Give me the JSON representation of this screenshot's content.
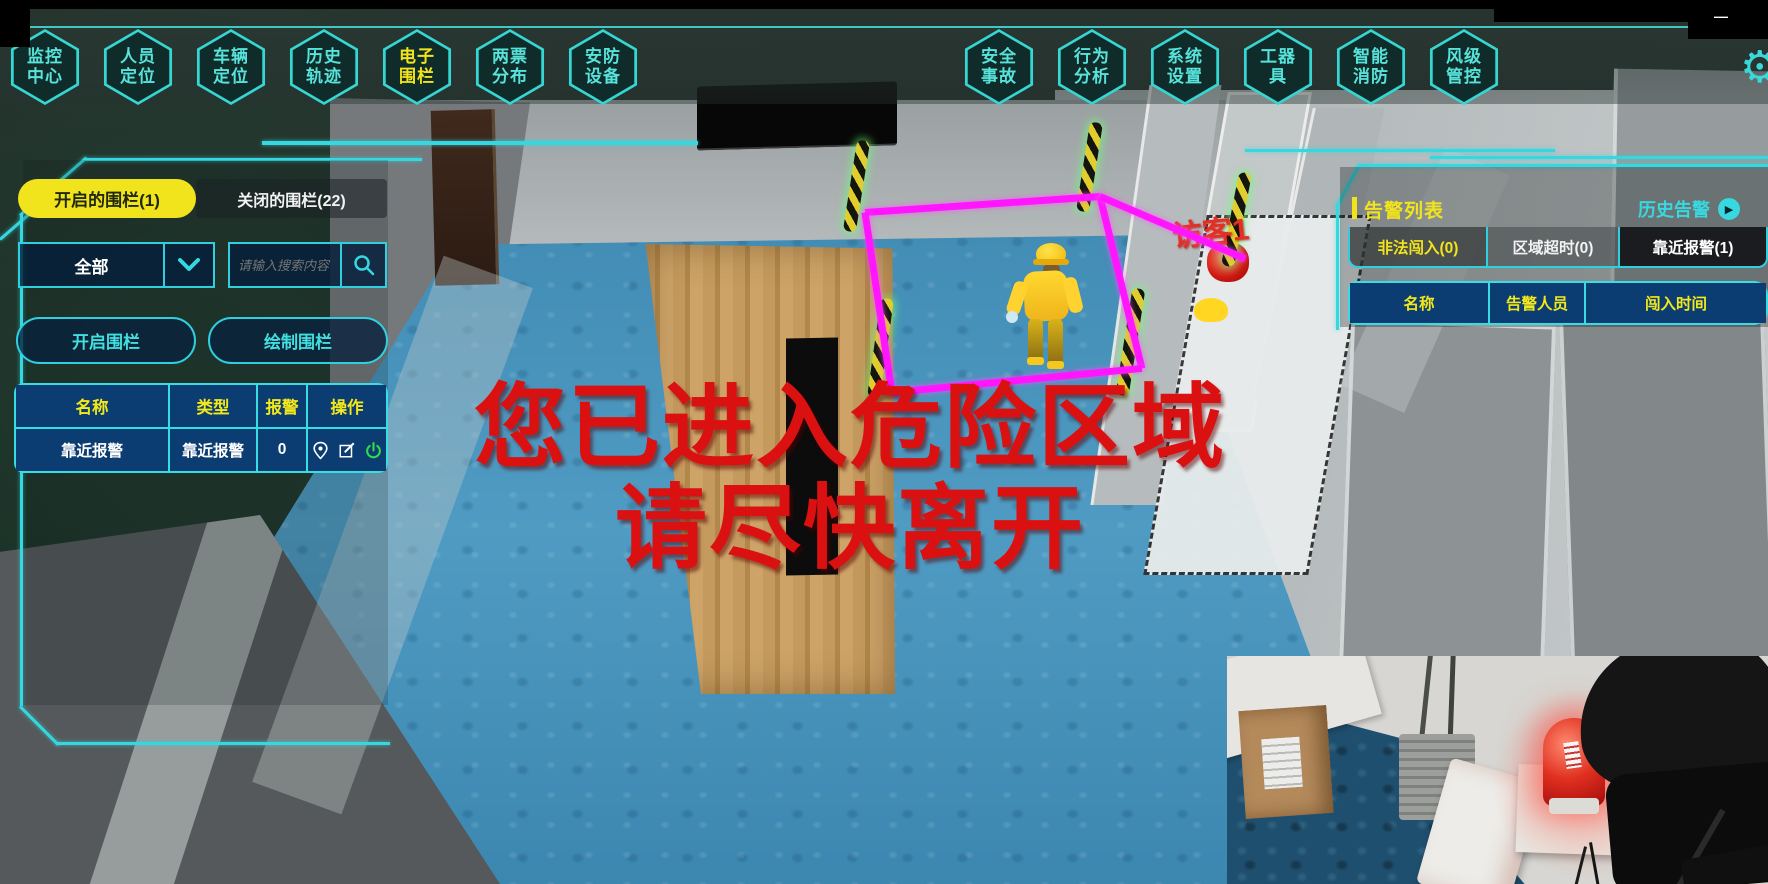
{
  "window": {
    "minimize_glyph": "—"
  },
  "nav": {
    "left": [
      {
        "line1": "监控",
        "line2": "中心"
      },
      {
        "line1": "人员",
        "line2": "定位"
      },
      {
        "line1": "车辆",
        "line2": "定位"
      },
      {
        "line1": "历史",
        "line2": "轨迹"
      },
      {
        "line1": "电子",
        "line2": "围栏"
      },
      {
        "line1": "两票",
        "line2": "分布"
      },
      {
        "line1": "安防",
        "line2": "设备"
      }
    ],
    "right": [
      {
        "line1": "安全",
        "line2": "事故"
      },
      {
        "line1": "行为",
        "line2": "分析"
      },
      {
        "line1": "系统",
        "line2": "设置"
      },
      {
        "line1": "工器",
        "line2": "具"
      },
      {
        "line1": "智能",
        "line2": "消防"
      },
      {
        "line1": "风级",
        "line2": "管控"
      }
    ],
    "active_item": "电子围栏"
  },
  "left_panel": {
    "tabs": [
      {
        "label": "开启的围栏(1)",
        "active": true
      },
      {
        "label": "关闭的围栏(22)",
        "active": false
      }
    ],
    "filter": {
      "value": "全部"
    },
    "search": {
      "placeholder": "请输入搜索内容"
    },
    "buttons": [
      {
        "label": "开启围栏"
      },
      {
        "label": "绘制围栏"
      }
    ],
    "table": {
      "headers": [
        "名称",
        "类型",
        "报警",
        "操作"
      ],
      "rows": [
        {
          "name": "靠近报警",
          "type": "靠近报警",
          "alarm": "0"
        }
      ]
    }
  },
  "alarm_panel": {
    "title": "告警列表",
    "history_label": "历史告警",
    "tabs": [
      {
        "label": "非法闯入(0)",
        "active": true
      },
      {
        "label": "区域超时(0)",
        "active": false
      },
      {
        "label": "靠近报警(1)",
        "active": false
      }
    ],
    "table_headers": [
      "名称",
      "告警人员",
      "闯入时间"
    ]
  },
  "warning": {
    "line1": "您已进入危险区域",
    "line2": "请尽快离开"
  },
  "scene": {
    "visitor_label": "访客1"
  },
  "colors": {
    "accent_cyan": "#35d8e0",
    "highlight_yellow": "#f2e41c",
    "table_blue": "#0c3d72",
    "alert_red": "#db1111",
    "fence_magenta": "#ff16ff",
    "power_green": "#2ede4a"
  }
}
